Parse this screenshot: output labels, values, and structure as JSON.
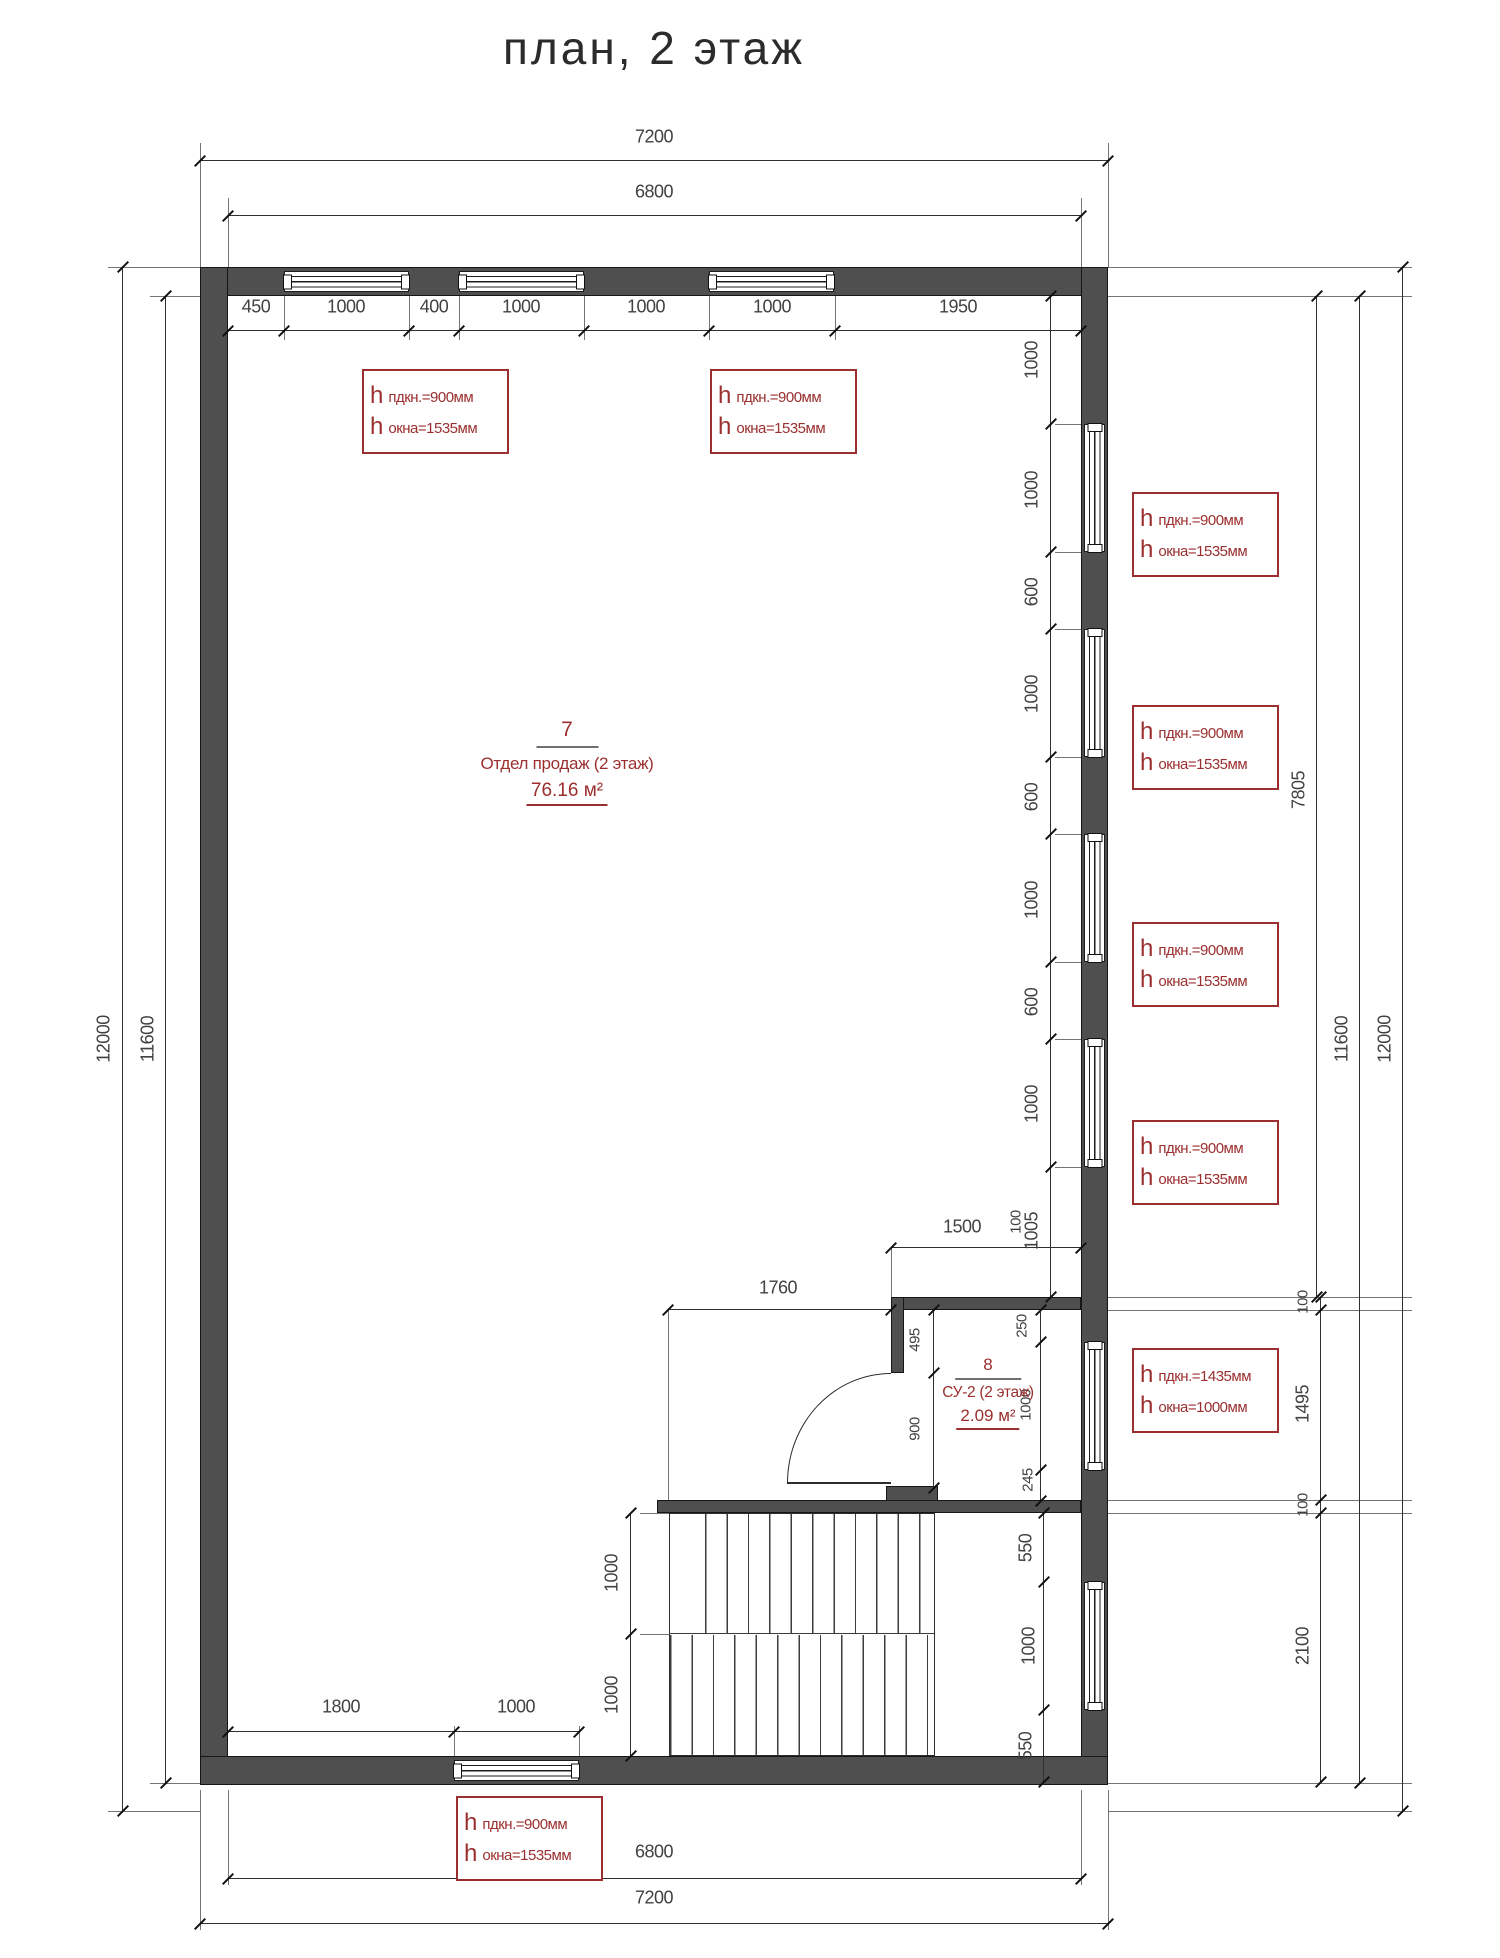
{
  "title": "план, 2 этаж",
  "colors": {
    "wall": "#4f4f4f",
    "line": "#2f2f2f",
    "annotation": "#9b2f2f"
  },
  "rooms": [
    {
      "number": "7",
      "name": "Отдел продаж (2 этаж)",
      "area": "76.16 м²"
    },
    {
      "number": "8",
      "name": "СУ-2 (2 этаж)",
      "area": "2.09 м²"
    }
  ],
  "annotation_boxes": [
    {
      "x": 362,
      "y": 369,
      "rows": [
        {
          "prefix": "h",
          "text": "пдкн.=900мм"
        },
        {
          "prefix": "h",
          "text": "окна=1535мм"
        }
      ]
    },
    {
      "x": 710,
      "y": 369,
      "rows": [
        {
          "prefix": "h",
          "text": "пдкн.=900мм"
        },
        {
          "prefix": "h",
          "text": "окна=1535мм"
        }
      ]
    },
    {
      "x": 1132,
      "y": 492,
      "rows": [
        {
          "prefix": "h",
          "text": "пдкн.=900мм"
        },
        {
          "prefix": "h",
          "text": "окна=1535мм"
        }
      ]
    },
    {
      "x": 1132,
      "y": 705,
      "rows": [
        {
          "prefix": "h",
          "text": "пдкн.=900мм"
        },
        {
          "prefix": "h",
          "text": "окна=1535мм"
        }
      ]
    },
    {
      "x": 1132,
      "y": 922,
      "rows": [
        {
          "prefix": "h",
          "text": "пдкн.=900мм"
        },
        {
          "prefix": "h",
          "text": "окна=1535мм"
        }
      ]
    },
    {
      "x": 1132,
      "y": 1120,
      "rows": [
        {
          "prefix": "h",
          "text": "пдкн.=900мм"
        },
        {
          "prefix": "h",
          "text": "окна=1535мм"
        }
      ]
    },
    {
      "x": 1132,
      "y": 1348,
      "rows": [
        {
          "prefix": "h",
          "text": "пдкн.=1435мм"
        },
        {
          "prefix": "h",
          "text": "окна=1000мм"
        }
      ]
    },
    {
      "x": 456,
      "y": 1796,
      "rows": [
        {
          "prefix": "h",
          "text": "пдкн.=900мм"
        },
        {
          "prefix": "h",
          "text": "окна=1535мм"
        }
      ]
    }
  ],
  "dim_labels": [
    {
      "t": "7200",
      "x": 654,
      "y": 137,
      "r": 0
    },
    {
      "t": "6800",
      "x": 654,
      "y": 192,
      "r": 0
    },
    {
      "t": "450",
      "x": 256,
      "y": 307,
      "r": 0
    },
    {
      "t": "1000",
      "x": 346,
      "y": 307,
      "r": 0
    },
    {
      "t": "400",
      "x": 434,
      "y": 307,
      "r": 0
    },
    {
      "t": "1000",
      "x": 521,
      "y": 307,
      "r": 0
    },
    {
      "t": "1000",
      "x": 646,
      "y": 307,
      "r": 0
    },
    {
      "t": "1000",
      "x": 772,
      "y": 307,
      "r": 0
    },
    {
      "t": "1950",
      "x": 958,
      "y": 307,
      "r": 0
    },
    {
      "t": "1500",
      "x": 962,
      "y": 1227,
      "r": 0
    },
    {
      "t": "1760",
      "x": 778,
      "y": 1288,
      "r": 0
    },
    {
      "t": "1800",
      "x": 341,
      "y": 1707,
      "r": 0
    },
    {
      "t": "1000",
      "x": 516,
      "y": 1707,
      "r": 0
    },
    {
      "t": "6800",
      "x": 654,
      "y": 1852,
      "r": 0
    },
    {
      "t": "7200",
      "x": 654,
      "y": 1898,
      "r": 0
    },
    {
      "t": "12000",
      "x": 104,
      "y": 1039,
      "r": 1
    },
    {
      "t": "11600",
      "x": 148,
      "y": 1039,
      "r": 1
    },
    {
      "t": "7805",
      "x": 1299,
      "y": 790,
      "r": 1
    },
    {
      "t": "11600",
      "x": 1342,
      "y": 1039,
      "r": 1
    },
    {
      "t": "12000",
      "x": 1385,
      "y": 1039,
      "r": 1
    },
    {
      "t": "100",
      "x": 1303,
      "y": 1302,
      "r": 1,
      "s": 1
    },
    {
      "t": "1495",
      "x": 1303,
      "y": 1404,
      "r": 1
    },
    {
      "t": "100",
      "x": 1303,
      "y": 1505,
      "r": 1,
      "s": 1
    },
    {
      "t": "2100",
      "x": 1303,
      "y": 1646,
      "r": 1
    },
    {
      "t": "1000",
      "x": 1032,
      "y": 360,
      "r": 1
    },
    {
      "t": "1000",
      "x": 1032,
      "y": 490,
      "r": 1
    },
    {
      "t": "600",
      "x": 1032,
      "y": 592,
      "r": 1
    },
    {
      "t": "1000",
      "x": 1032,
      "y": 694,
      "r": 1
    },
    {
      "t": "600",
      "x": 1032,
      "y": 797,
      "r": 1
    },
    {
      "t": "1000",
      "x": 1032,
      "y": 900,
      "r": 1
    },
    {
      "t": "600",
      "x": 1032,
      "y": 1002,
      "r": 1
    },
    {
      "t": "1000",
      "x": 1032,
      "y": 1104,
      "r": 1
    },
    {
      "t": "1005",
      "x": 1032,
      "y": 1231,
      "r": 1
    },
    {
      "t": "100",
      "x": 1016,
      "y": 1222,
      "r": 1,
      "s": 1
    },
    {
      "t": "1000",
      "x": 612,
      "y": 1573,
      "r": 1
    },
    {
      "t": "1000",
      "x": 612,
      "y": 1695,
      "r": 1
    },
    {
      "t": "495",
      "x": 915,
      "y": 1340,
      "r": 1,
      "s": 1
    },
    {
      "t": "900",
      "x": 915,
      "y": 1429,
      "r": 1,
      "s": 1
    },
    {
      "t": "250",
      "x": 1022,
      "y": 1326,
      "r": 1,
      "s": 1
    },
    {
      "t": "1000",
      "x": 1026,
      "y": 1405,
      "r": 1,
      "s": 1
    },
    {
      "t": "245",
      "x": 1028,
      "y": 1480,
      "r": 1,
      "s": 1
    },
    {
      "t": "550",
      "x": 1026,
      "y": 1548,
      "r": 1
    },
    {
      "t": "1000",
      "x": 1029,
      "y": 1646,
      "r": 1
    },
    {
      "t": "550",
      "x": 1026,
      "y": 1746,
      "r": 1
    }
  ]
}
